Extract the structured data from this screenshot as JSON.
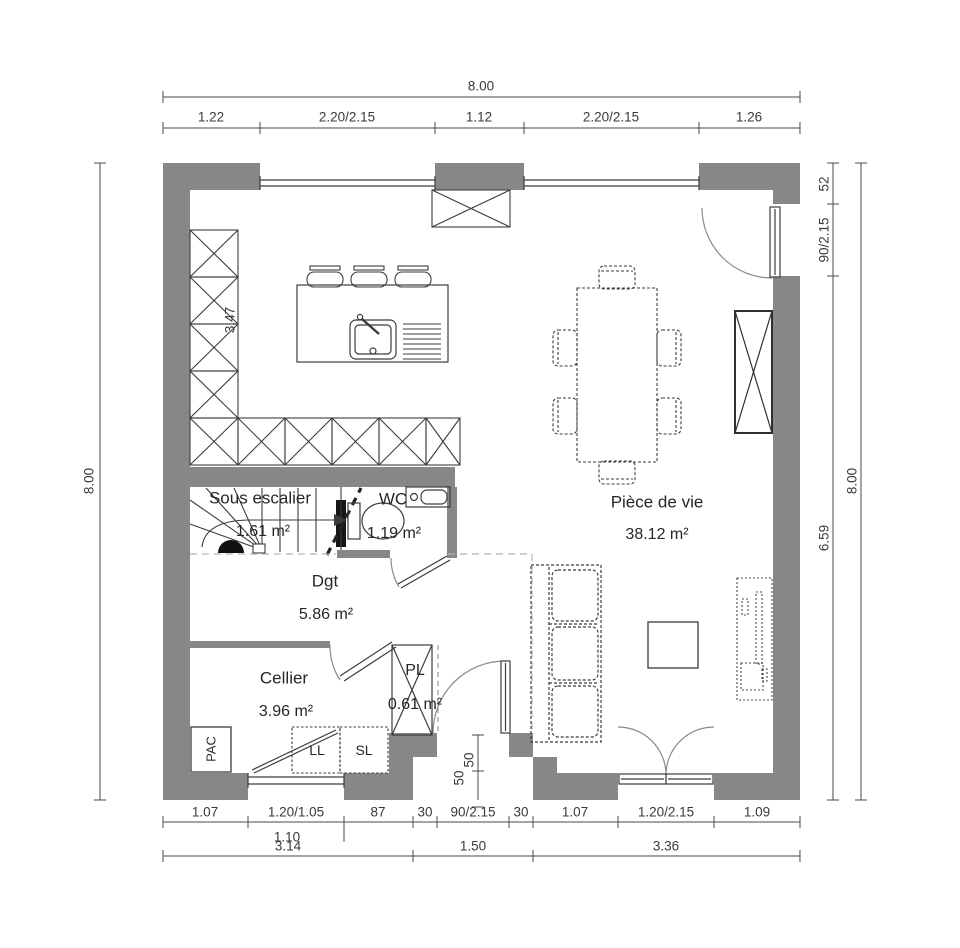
{
  "colors": {
    "wall": "#878787",
    "line": "#444444",
    "dim_text": "#3a3a3a"
  },
  "rooms": {
    "sous_escalier": {
      "name": "Sous escalier",
      "area": "1.61 m²"
    },
    "wc": {
      "name": "WC",
      "area": "1.19 m²"
    },
    "dgt": {
      "name": "Dgt",
      "area": "5.86 m²"
    },
    "cellier": {
      "name": "Cellier",
      "area": "3.96 m²"
    },
    "pl": {
      "name": "PL",
      "area": "0.61 m²"
    },
    "piece_de_vie": {
      "name": "Pièce de vie",
      "area": "38.12 m²"
    }
  },
  "equipment": {
    "pac": "PAC",
    "ll": "LL",
    "sl": "SL"
  },
  "dims": {
    "top_total": "8.00",
    "top_segments": [
      "1.22",
      "2.20/2.15",
      "1.12",
      "2.20/2.15",
      "1.26"
    ],
    "left_total": "8.00",
    "right_total": "8.00",
    "right_segments": [
      "52",
      "90/2.15",
      "6.59"
    ],
    "bottom_row1": [
      "1.07",
      "1.20/1.05",
      "87",
      "30",
      "90/2.15",
      "30",
      "1.07",
      "1.20/2.15",
      "1.09"
    ],
    "bottom_sub": "1.10",
    "bottom_row2": [
      "3.14",
      "1.50",
      "3.36"
    ],
    "kitchen_depth": "3.47",
    "recess_a": "50",
    "recess_b": "50"
  }
}
